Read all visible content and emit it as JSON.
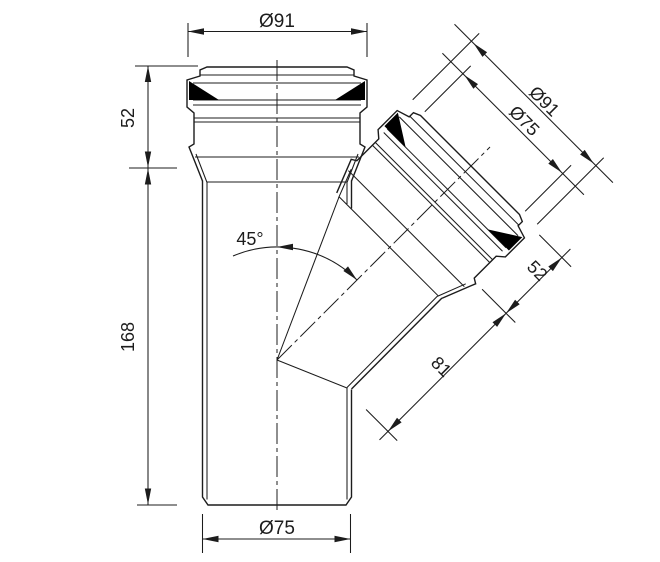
{
  "drawing": {
    "dimensions": {
      "top_outer_diameter": "Ø91",
      "main_socket_depth": "52",
      "main_body_length": "168",
      "bottom_outer_diameter": "Ø75",
      "branch_outer_diameter": "Ø91",
      "branch_inner_diameter": "Ø75",
      "branch_socket_depth": "52",
      "branch_tube_length": "81",
      "branch_angle": "45°"
    },
    "colors": {
      "line": "#1c1c1c",
      "background": "#ffffff",
      "seal": "#000000"
    }
  }
}
